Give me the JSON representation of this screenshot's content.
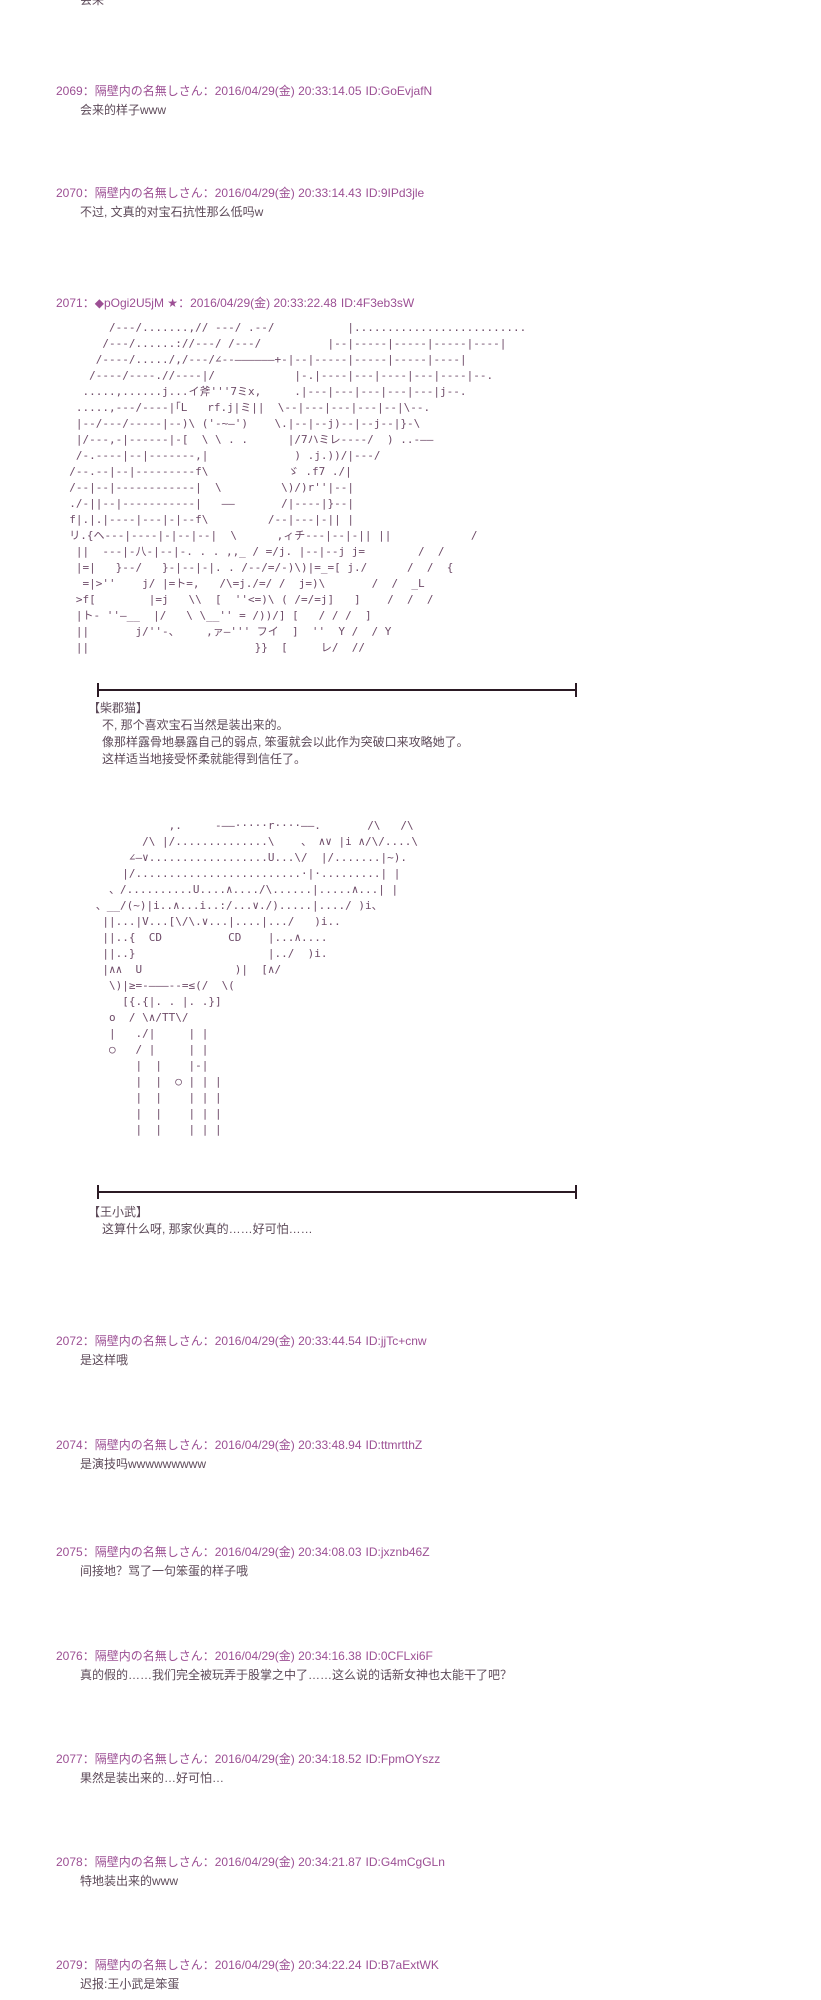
{
  "page": {
    "sep": "：",
    "bg": "#ffffff",
    "header_color": "#9c4f94",
    "body_color": "#5d4a59",
    "aa_color": "#6e4b68",
    "divider_color": "#2b1a24"
  },
  "top_partial": "会来",
  "posts": [
    {
      "number": "2069",
      "name": "隔壁内の名無しさん",
      "datetime": "2016/04/29(金) 20:33:14.05",
      "id": "ID:GoEvjafN",
      "body": [
        "会来的样子www"
      ]
    },
    {
      "number": "2070",
      "name": "隔壁内の名無しさん",
      "datetime": "2016/04/29(金) 20:33:14.43",
      "id": "ID:9IPd3jle",
      "body": [
        "不过, 文真的对宝石抗性那么低吗w"
      ]
    },
    {
      "number": "2071",
      "name": "◆pOgi2U5jM ★",
      "datetime": "2016/04/29(金) 20:33:22.48",
      "id": "ID:4F3eb3sW",
      "aa_first": [
        "        /---/.......,// ---/ .--/           |..........................",
        "       /---/......://---/ /---/          |--|-----|-----|-----|----|",
        "      /----/...../,/---/∠--——————+-|--|-----|-----|-----|----|",
        "     /----/----.//----|/            |-.|----|---|----|---|----|--.",
        "    .....,......j...イ斧'''7ミx,     .|---|---|---|---|---|j--.",
        "   .....,---/----|｢L   rf.j|ミ||  \\--|---|---|---|--|\\--.",
        "   |--/---/-----|--)\\ ('-~—')    \\.|--|--j)--|--j--|}-\\",
        "   |/---,-|------|-[  \\ \\ . .      |/7ハミレ----/  ) ..-——",
        "   /-.----|--|-------,|             ) .j.))/|---/",
        "  /--.--|--|---------f\\            ゞ .f7 ./|",
        "  /--|--|------------|  \\         \\)/)r''|--|",
        "  ./-||--|-----------|   ——       /|----|}--|",
        "  f|.|.|----|---|-|--f\\         /--|---|-|| |",
        "  リ.{ヘ---|----|-|--|--|  \\      ,ィチ---|--|-|| ||            /",
        "   ||  ---|-八-|--|-. . . ,,_ / =/j. |--|--j j=        /  /",
        "   |=|   }--/   }-|--|-|. . /--/=/-)\\)|=_=[ j./      /  /  {",
        "    =|>''    j/ |=ト=,   /\\=j./=/ /  j=)\\       /  /  _L",
        "   >f[        |=j   \\\\  [  ''<=)\\ ( /=/=j]   ]    /  /  /",
        "   |ト- ''—__  |/   \\ \\__'' = /))/] [   / / /  ]",
        "   ||       j/''-、    ,ァ—''' フイ  ]  ''  Y /  / Y",
        "   ||                         }}  [     レ/  //"
      ],
      "dialogue_first": {
        "speaker": "【柴郡猫】",
        "lines": [
          "不, 那个喜欢宝石当然是装出来的。",
          "像那样露骨地暴露自己的弱点, 笨蛋就会以此作为突破口来攻略她了。",
          "这样适当地接受怀柔就能得到信任了。"
        ]
      },
      "aa_second": [
        "                 ,.     -——·····r····——.       /\\   /\\",
        "             /\\ |/..............\\    、 ∧∨ |i ∧/\\/....\\",
        "           ∠—∨..................U...\\/  |/.......|~).",
        "          |/.........................·|·.........| |",
        "        、/..........U....∧..../\\......|.....∧...| |",
        "      、__/(~)|i..∧...i..:/...∨./).....|..../ )i、",
        "       ||...|V...[\\/\\.∨...|....|.../   )i..",
        "       ||..{  CD          CD    |...∧....",
        "       ||..}                    |../  )i.",
        "       |∧∧  U              )|  [∧/",
        "        \\)|≥=-———--=≤(/  \\(",
        "          [{.{|. . |. .}]",
        "        o  / \\∧/TT\\/",
        "        |   ./|     | |",
        "        ○   / |     | |",
        "            |  |    |-|",
        "            |  |  ○ | | |",
        "            |  |    | | |",
        "            |  |    | | |",
        "            |  |    | | |"
      ],
      "dialogue_second": {
        "speaker": "【王小武】",
        "lines": [
          "这算什么呀, 那家伙真的……好可怕……"
        ]
      }
    },
    {
      "number": "2072",
      "name": "隔壁内の名無しさん",
      "datetime": "2016/04/29(金) 20:33:44.54",
      "id": "ID:jjTc+cnw",
      "body": [
        "是这样哦"
      ]
    },
    {
      "number": "2074",
      "name": "隔壁内の名無しさん",
      "datetime": "2016/04/29(金) 20:33:48.94",
      "id": "ID:ttmrtthZ",
      "body": [
        "是演技吗wwwwwwwww"
      ]
    },
    {
      "number": "2075",
      "name": "隔壁内の名無しさん",
      "datetime": "2016/04/29(金) 20:34:08.03",
      "id": "ID:jxznb46Z",
      "body": [
        "间接地？骂了一句笨蛋的样子哦"
      ]
    },
    {
      "number": "2076",
      "name": "隔壁内の名無しさん",
      "datetime": "2016/04/29(金) 20:34:16.38",
      "id": "ID:0CFLxi6F",
      "body": [
        "真的假的……我们完全被玩弄于股掌之中了……这么说的话新女神也太能干了吧？"
      ]
    },
    {
      "number": "2077",
      "name": "隔壁内の名無しさん",
      "datetime": "2016/04/29(金) 20:34:18.52",
      "id": "ID:FpmOYszz",
      "body": [
        "果然是装出来的…好可怕…"
      ]
    },
    {
      "number": "2078",
      "name": "隔壁内の名無しさん",
      "datetime": "2016/04/29(金) 20:34:21.87",
      "id": "ID:G4mCgGLn",
      "body": [
        "特地装出来的www"
      ]
    },
    {
      "number": "2079",
      "name": "隔壁内の名無しさん",
      "datetime": "2016/04/29(金) 20:34:22.24",
      "id": "ID:B7aExtWK",
      "body": [
        "迟报:王小武是笨蛋"
      ]
    }
  ]
}
